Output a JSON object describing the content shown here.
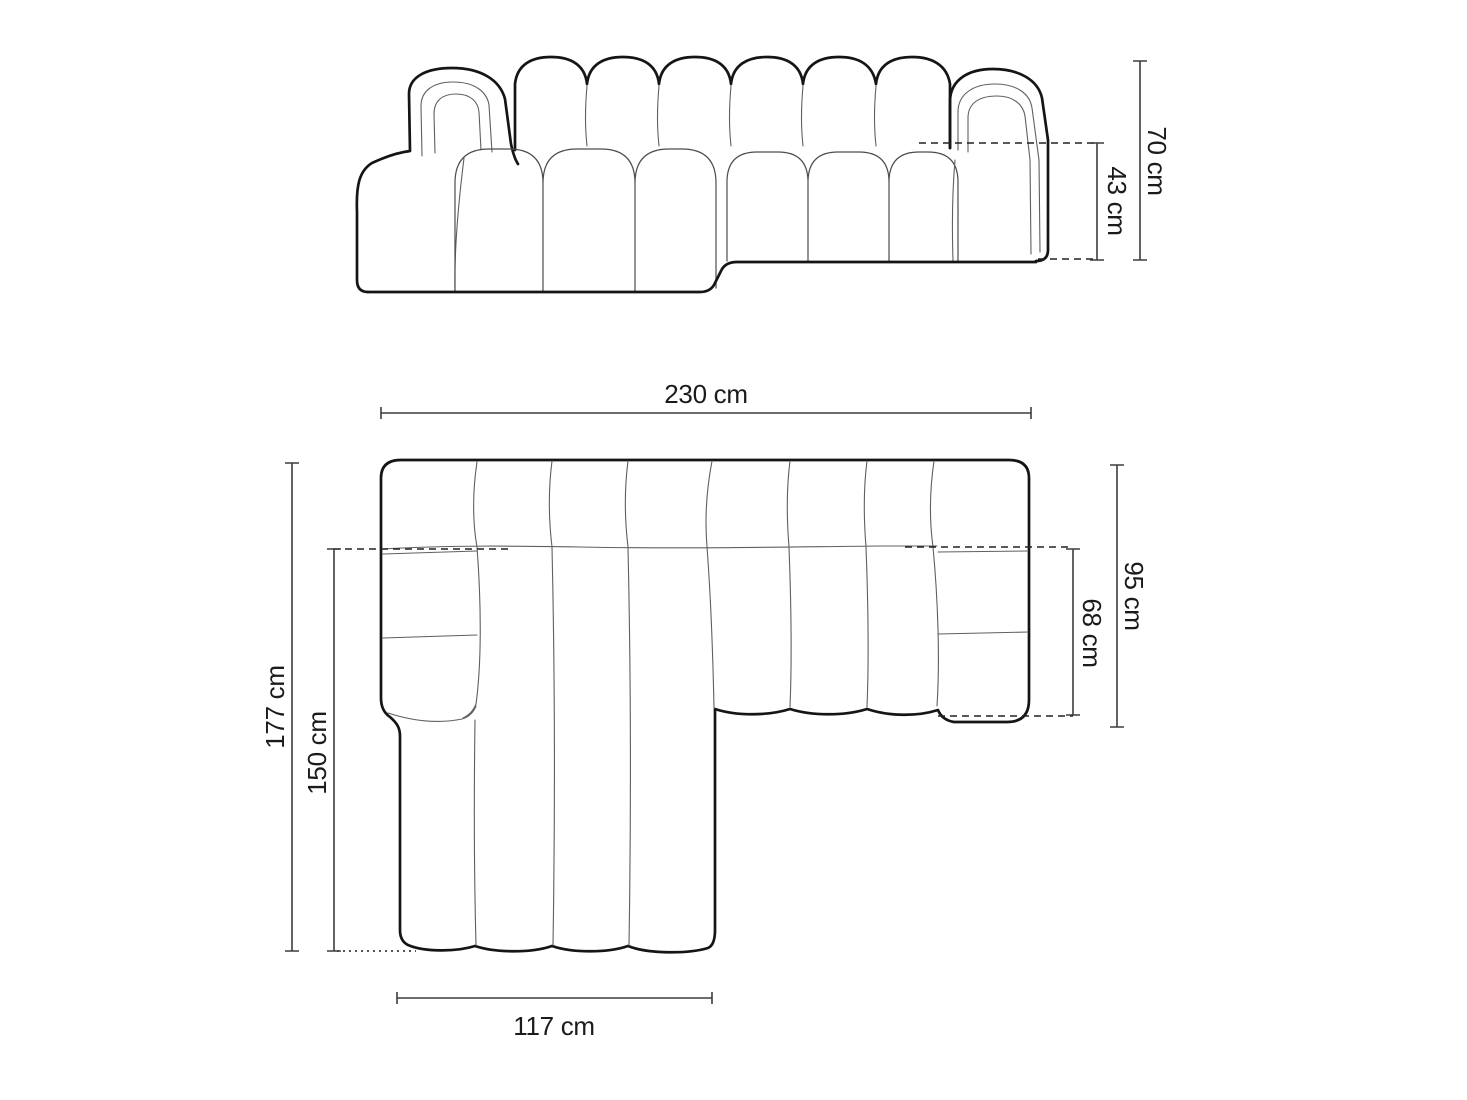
{
  "page": {
    "background": "#ffffff",
    "content": "sofa-dimension-diagram"
  },
  "colors": {
    "outline": "#151515",
    "seam": "#606060",
    "cushion_line": "#4c4c4c",
    "dimension_line": "#3d3d3d",
    "dashed_line": "#222222",
    "label_text": "#1b1b1b"
  },
  "front_view": {
    "dim_total_height": "70 cm",
    "dim_seat_height": "43 cm"
  },
  "top_view": {
    "dim_total_width": "230 cm",
    "dim_total_depth": "177 cm",
    "dim_chaise_depth": "150 cm",
    "dim_side_depth": "95 cm",
    "dim_seat_depth": "68 cm",
    "dim_chaise_width": "117 cm"
  }
}
